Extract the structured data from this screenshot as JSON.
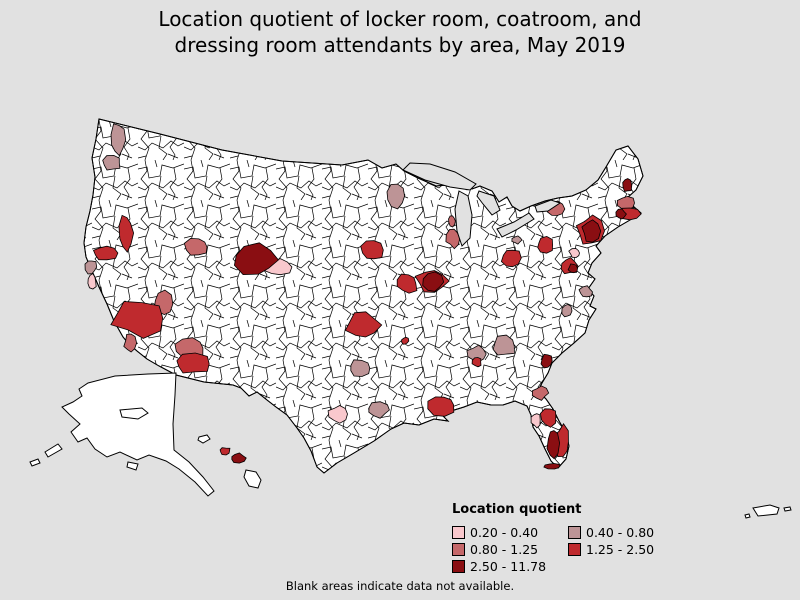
{
  "header": {
    "title_line1": "Location quotient of locker room, coatroom, and",
    "title_line2": "dressing room attendants by area, May 2019"
  },
  "legend": {
    "title": "Location quotient",
    "items": [
      {
        "label": "0.20 - 0.40",
        "color": "#f9c8cd"
      },
      {
        "label": "0.40 - 0.80",
        "color": "#bd9496"
      },
      {
        "label": "0.80 - 1.25",
        "color": "#c5686a"
      },
      {
        "label": "1.25 - 2.50",
        "color": "#bf2a2e"
      },
      {
        "label": "2.50 - 11.78",
        "color": "#8a0e12"
      }
    ]
  },
  "footer": {
    "note": "Blank areas indicate data not available."
  },
  "map": {
    "background": "#e1e1e1",
    "land_fill": "#ffffff",
    "border_color": "#000000",
    "palette": {
      "no_data": "#ffffff",
      "q1": "#f9c8cd",
      "q2": "#bd9496",
      "q3": "#c5686a",
      "q4": "#bf2a2e",
      "q5": "#8a0e12"
    },
    "classes": [
      {
        "range": "0.20 - 0.40",
        "color": "#f9c8cd"
      },
      {
        "range": "0.40 - 0.80",
        "color": "#bd9496"
      },
      {
        "range": "0.80 - 1.25",
        "color": "#c5686a"
      },
      {
        "range": "1.25 - 2.50",
        "color": "#bf2a2e"
      },
      {
        "range": "2.50 - 11.78",
        "color": "#8a0e12"
      }
    ]
  }
}
